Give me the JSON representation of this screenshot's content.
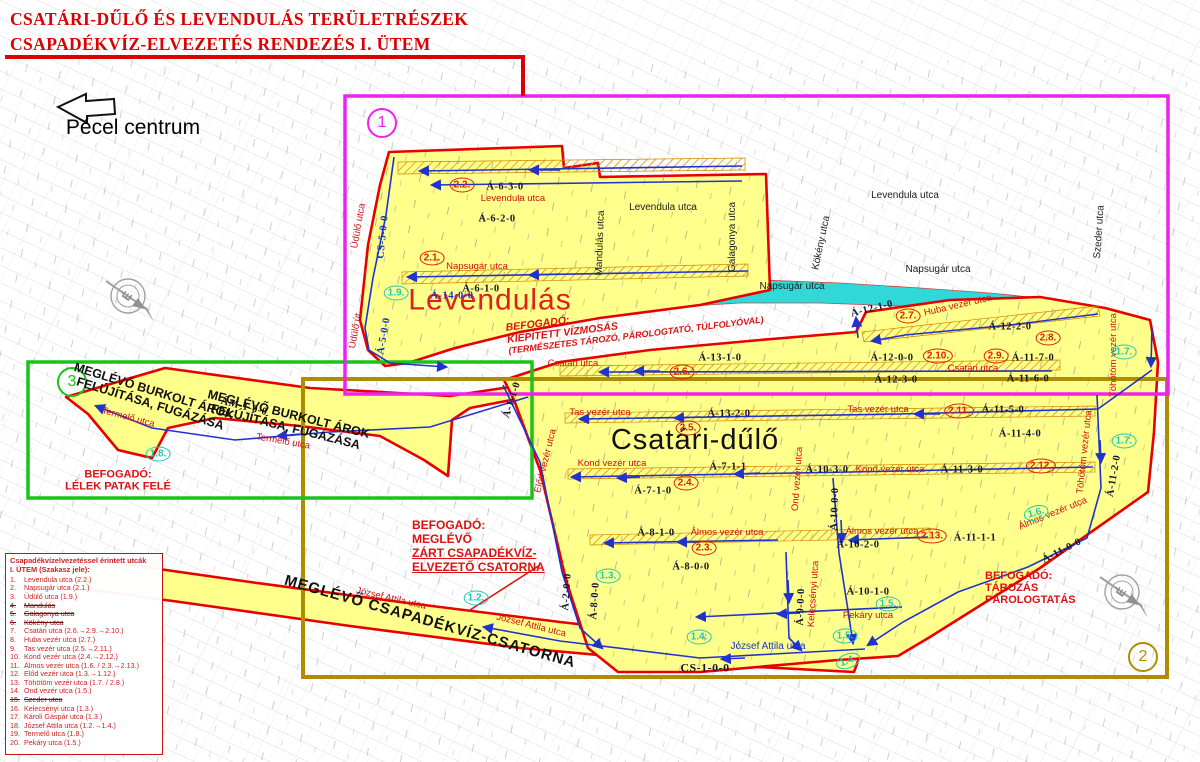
{
  "title": {
    "line1": "CSATÁRI-DŰLŐ ÉS LEVENDULÁS TERÜLETRÉSZEK",
    "line2": "CSAPADÉKVÍZ-ELVEZETÉS RENDEZÉS I. ÜTEM"
  },
  "orientation": {
    "pecel": "Pécel centrum",
    "north": "É"
  },
  "area_names": {
    "levendulas": "Levendulás",
    "csatari": "Csatári-dűlő"
  },
  "section_markers": {
    "magenta": "1",
    "olive": "2",
    "green": "3"
  },
  "colors": {
    "magenta_box": "#ee22ee",
    "olive_box": "#b08c00",
    "green_box": "#18c418",
    "water": "#30d8d8",
    "highlight": "#ffff8c",
    "boundary_red": "#e80000",
    "drain_blue": "#2233cc",
    "ref_red": "#dd2200",
    "ref_cyan": "#1fc9b9"
  },
  "notes": {
    "water": [
      "BEFOGADÓ:",
      "KIÉPÍTETT VÍZMOSÁS",
      "(TERMÉSZETES TÁROZÓ, PÁROLOGTATÓ, TÚLFOLYÓVAL)"
    ],
    "zart": [
      "BEFOGADÓ:",
      "MEGLÉVŐ",
      "ZÁRT CSAPADÉKVÍZ-",
      "ELVEZETŐ CSATORNA"
    ],
    "tarozas": [
      "BEFOGADÓ:",
      "TÁROZÁS",
      "PÁROLOGTATÁS"
    ],
    "lelek": [
      "BEFOGADÓ:",
      "LÉLEK PATAK FELÉ"
    ],
    "burkolt1": [
      "MEGLÉVŐ BURKOLT ÁROK",
      "FELÚJÍTÁSA, FUGÁZÁSA"
    ],
    "burkolt2": [
      "MEGLÉVŐ BURKOLT ÁROK",
      "FELÚJÍTÁSA, FUGÁZÁSA"
    ],
    "csatorna": "MEGLÉVŐ CSAPADÉKVÍZ-CSATORNA"
  },
  "labels": {
    "black": {
      "lev1": "Levendula utca",
      "lev2": "Levendula utca",
      "nap1": "Napsugár utca",
      "nap2": "Napsugár utca",
      "gal": "Galagonya utca",
      "kok": "Kökény utca",
      "szed": "Szeder utca",
      "mand": "Mandulás utca"
    },
    "red": {
      "levr": "Levendula utca",
      "napr": "Napsugár utca",
      "csat1": "Csatári utca",
      "csat2": "Csatári utca",
      "huba": "Huba vezér utca",
      "tas1": "Tas vezér utca",
      "tas2": "Tas vezér utca",
      "kond1": "Kond vezér utca",
      "kond2": "Kond vezér utca",
      "alm1": "Álmos vezér utca",
      "alm2": "Álmos vezér utca",
      "alm3": "Álmos vezér utca",
      "pek": "Pekáry utca",
      "joz1": "József Attila utca",
      "joz2": "József Attila utca",
      "udu1": "Üdülő utca",
      "udu2": "Üdülő út",
      "term1": "Termelő utca",
      "term2": "Termelő utca",
      "elod": "Előd vezér utca",
      "ond": "Ond vezér utca",
      "toh1": "Töhötöm vezér utca",
      "toh2": "Töhötöm vezér utca",
      "kel": "Kelecsényi utca"
    },
    "blue": {
      "joz3": "József Attila utca",
      "a14": "Á-14-0-0",
      "cs5": "CS-5-0-0",
      "a5": "Á-5-0-0"
    },
    "codes": {
      "c630": "Á-6-3-0",
      "c620": "Á-6-2-0",
      "c610": "Á-6-1-0",
      "c1210": "Á-12-1-0",
      "c1220": "Á-12-2-0",
      "c1170": "Á-11-7-0",
      "c1200": "Á-12-0-0",
      "c1230": "Á-12-3-0",
      "c1160": "Á-11-6-0",
      "c1310": "Á-13-1-0",
      "c1320": "Á-13-2-0",
      "c1150": "Á-11-5-0",
      "c1140": "Á-11-4-0",
      "c711": "Á-7-1-1",
      "c1030": "Á-10-3-0",
      "c1130": "Á-11-3-0",
      "c710": "Á-7-1-0",
      "c810": "Á-8-1-0",
      "c800": "Á-8-0-0",
      "c1020": "Á-10-2-0",
      "c1111": "Á-11-1-1",
      "c1100": "Á-11-0-0",
      "c1010": "Á-10-1-0",
      "c110": "Á-1-1-0",
      "c200": "Á-2-0-0",
      "c800v": "Á-8-0-0",
      "c900": "Á-9-0-0",
      "c1000": "Á-10-0-0",
      "c1120": "Á-11-2-0",
      "cs1": "CS-1-0-0",
      "am1": "ÁM-1-0-0"
    }
  },
  "refs": {
    "red": {
      "r22": "2.2.",
      "r21": "2.1.",
      "r26": "2.6.",
      "r25": "2.5.",
      "r24": "2.4.",
      "r23": "2.3.",
      "r27": "2.7.",
      "r28": "2.8.",
      "r29": "2.9.",
      "r210": "2.10.",
      "r211": "2.11.",
      "r212": "2.12.",
      "r213": "2.13."
    },
    "cyan": {
      "y12": "1.2.",
      "y13": "1.3.",
      "y14a": "1.4.",
      "y14b": "1.4.",
      "y15a": "1.5.",
      "y15b": "1.5.",
      "y16": "1.6.",
      "y17a": "1.7.",
      "y17b": "1.7.",
      "y18": "1.8.",
      "y19": "1.9."
    }
  },
  "legend": {
    "title1": "Csapadékvízelvezetéssel érintett utcák",
    "title2": "I. ÜTEM (Szakasz jele):",
    "items": [
      {
        "n": "1.",
        "t": "Levendula utca (2.2.)",
        "s": false
      },
      {
        "n": "2.",
        "t": "Napsugár utca (2.1.)",
        "s": false
      },
      {
        "n": "3.",
        "t": "Üdülő utca (1.9.)",
        "s": false
      },
      {
        "n": "4.",
        "t": "Mandulás",
        "s": true
      },
      {
        "n": "5.",
        "t": "Galagonya utca",
        "s": true
      },
      {
        "n": "6.",
        "t": "Kökény utca",
        "s": true
      },
      {
        "n": "7.",
        "t": "Csatári utca (2.6.→2.9.→2.10.)",
        "s": false
      },
      {
        "n": "8.",
        "t": "Huba vezér utca (2.7.)",
        "s": false
      },
      {
        "n": "9.",
        "t": "Tas vezér utca (2.5.→2.11.)",
        "s": false
      },
      {
        "n": "10.",
        "t": "Kond vezér utca (2.4.→2.12.)",
        "s": false
      },
      {
        "n": "11.",
        "t": "Álmos vezér utca (1.6. / 2.3.→2.13.)",
        "s": false
      },
      {
        "n": "12.",
        "t": "Előd vezér utca (1.3.→1.12.)",
        "s": false
      },
      {
        "n": "13.",
        "t": "Töhötöm vezér utca (1.7. / 2.8.)",
        "s": false
      },
      {
        "n": "14.",
        "t": "Ond vezér utca (1.5.)",
        "s": false
      },
      {
        "n": "15.",
        "t": "Szeder utca",
        "s": true
      },
      {
        "n": "16.",
        "t": "Kelecsényi utca (1.3.)",
        "s": false
      },
      {
        "n": "17.",
        "t": "Károli Gáspár utca (1.3.)",
        "s": false
      },
      {
        "n": "18.",
        "t": "József Attila utca (1.2.→1.4.)",
        "s": false
      },
      {
        "n": "19.",
        "t": "Termelő utca (1.8.)",
        "s": false
      },
      {
        "n": "20.",
        "t": "Pekáry utca (1.5.)",
        "s": false
      }
    ]
  }
}
